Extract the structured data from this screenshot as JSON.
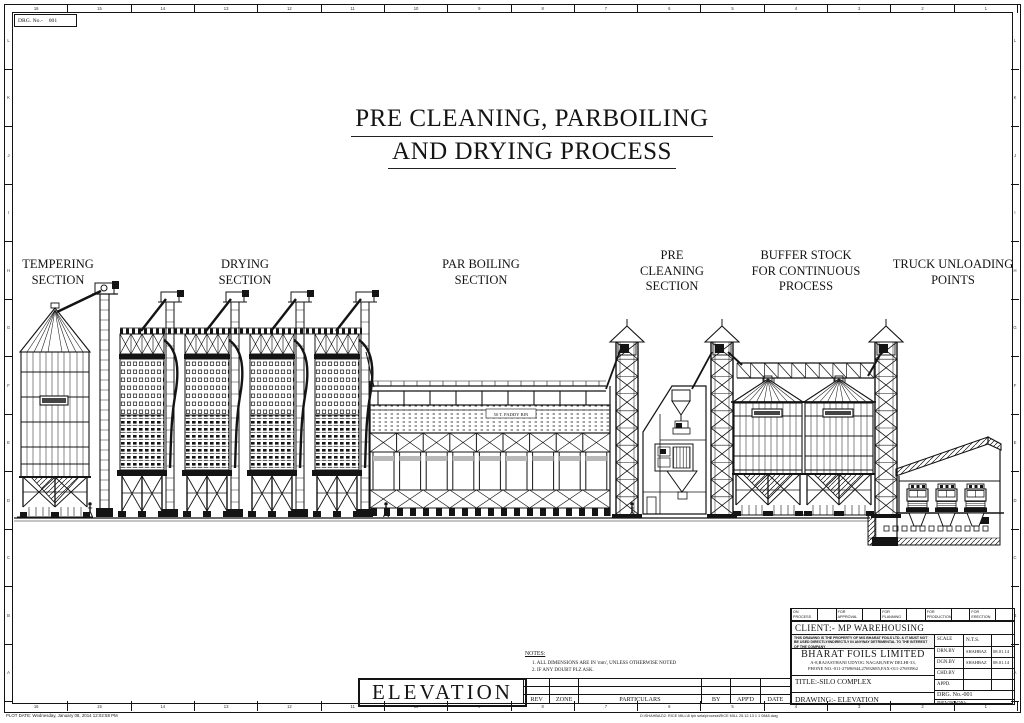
{
  "sheet": {
    "drg_no_label": "DRG. No.-",
    "drg_no_value": "001",
    "plot_date": "PLOT DATE:  Wednesday, January 08, 2014 12:02:58 PM",
    "file_path": "D:\\SHAHBAZ\\2. RICE MILL\\8 tph sela\\process\\RICE MILL 25.12.13  1 1 0848.dwg"
  },
  "border": {
    "column_numbers": [
      "16",
      "15",
      "14",
      "13",
      "12",
      "11",
      "10",
      "9",
      "8",
      "7",
      "6",
      "5",
      "4",
      "3",
      "2",
      "1"
    ],
    "row_letters": [
      "L",
      "K",
      "J",
      "I",
      "H",
      "G",
      "F",
      "E",
      "D",
      "C",
      "B",
      "A"
    ]
  },
  "title": {
    "line1": "PRE CLEANING, PARBOILING",
    "line2": "AND DRYING PROCESS"
  },
  "sections": {
    "tempering": "TEMPERING\nSECTION",
    "drying": "DRYING\nSECTION",
    "parboiling": "PAR BOILING\nSECTION",
    "precleaning": "PRE\nCLEANING\nSECTION",
    "buffer": "BUFFER STOCK\nFOR CONTINUOUS\nPROCESS",
    "truck": "TRUCK UNLOADING\nPOINTS"
  },
  "drawing_annotations": {
    "paddy_bin": "50 T. PADDY BIN"
  },
  "notes": {
    "heading": "NOTES:",
    "items": [
      "1. ALL DIMENSIONS ARE IN 'mm', UNLESS OTHERWISE NOTED",
      "2. IF ANY DOUBT PLZ ASK."
    ]
  },
  "view_label": "ELEVATION",
  "rev_table": {
    "headers": [
      "REV",
      "ZONE",
      "PARTICULARS",
      "BY",
      "APP'D",
      "DATE"
    ]
  },
  "title_block": {
    "status_cells": [
      "ON\nPROCESS",
      "FOR\nAPPROVAL",
      "FOR\nPLANNING",
      "FOR\nPRODUCTION",
      "FOR\nERECTION"
    ],
    "client": "CLIENT:- MP WAREHOUSING",
    "disclaimer": "THIS DRAWING IS THE PROPERTY OF M/S BHARAT FOILS LTD. & IT MUST NOT BE USED DIRECTLY/INDIRECTLY IN ANYWAY DETRIMENTAL TO THE INTEREST OF THE COMPANY",
    "company": "BHARAT FOILS LIMITED",
    "address_line1": "A-8,RAJASTHANI UDYOG NAGAR,NEW DELHI-33,",
    "address_line2": "PHONE NO.-011-27696944,27692685,FAX-011-27693962",
    "scale_label": "SCALE",
    "scale_value": "N.T.S.",
    "rows": [
      {
        "label": "DRN.BY",
        "value": "SHAHBAZ",
        "date": "08.01.14"
      },
      {
        "label": "DGN.BY",
        "value": "SHAHBAZ",
        "date": "08.01.14"
      },
      {
        "label": "CHD.BY",
        "value": "",
        "date": ""
      },
      {
        "label": "APPD.",
        "value": "",
        "date": ""
      }
    ],
    "title": "TITLE:-SILO COMPLEX",
    "drawing": "DRAWING:- ELEVATION",
    "drg_no": "DRG. No.-001",
    "revision": "REVISION:-"
  }
}
